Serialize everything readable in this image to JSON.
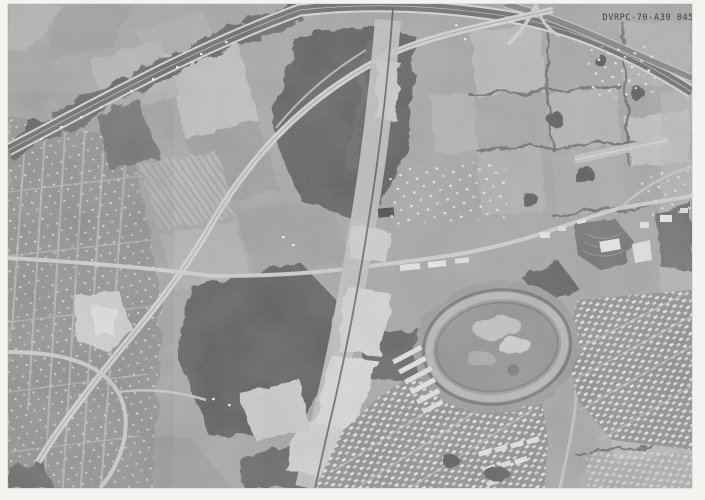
{
  "photo_label": {
    "text": "DVRPC-70-A39 045"
  },
  "palette": {
    "page_border": "#f4f3ef",
    "photo_base": "#a4a4a4",
    "woods": "#565656",
    "bright_road": "#d6d6d6",
    "label_ink": "#32322f"
  },
  "features": {
    "kind": "black-and-white aerial photograph",
    "landmarks": [
      "arterial-highway",
      "curved-bypass-road",
      "freeway-construction-corridor",
      "railroad-line",
      "racetrack-oval",
      "drive-in-theater",
      "housing-development",
      "town-street-grid",
      "farm-fields",
      "woodlots",
      "gravel-pit"
    ]
  }
}
